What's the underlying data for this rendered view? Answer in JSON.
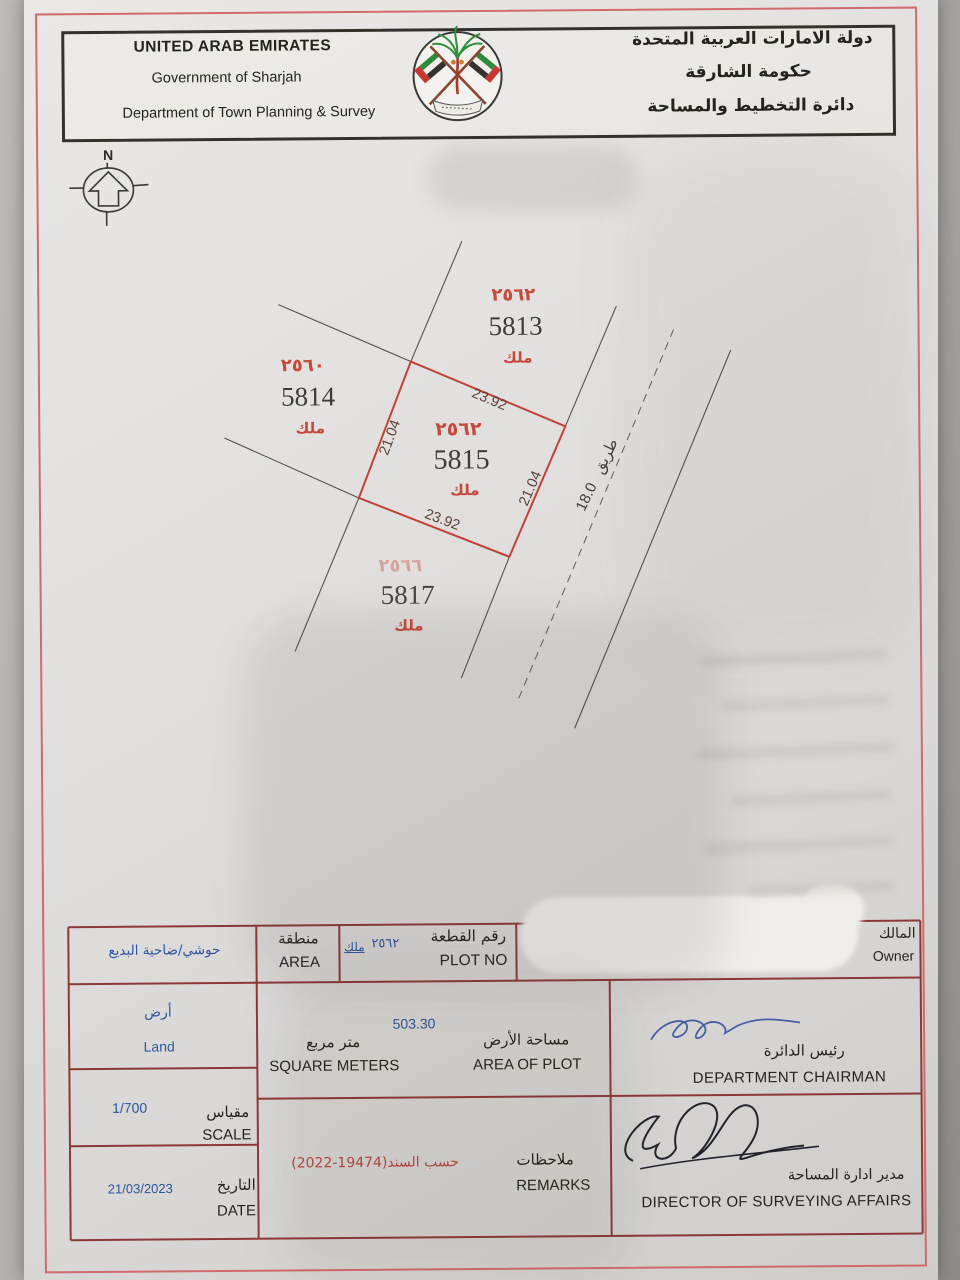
{
  "header": {
    "en_line1": "UNITED ARAB EMIRATES",
    "en_line2": "Government of Sharjah",
    "en_line3": "Department of Town Planning & Survey",
    "ar_line1": "دولة الامارات العربية المتحدة",
    "ar_line2": "حكومة الشارقة",
    "ar_line3": "دائرة التخطيط والمساحة",
    "emblem": "sharjah-uae-crossed-flags-palm-emblem"
  },
  "map": {
    "north_label": "N",
    "plots": [
      {
        "id": "5813",
        "serial_ar": "٢٥٦٢",
        "ownership_ar": "ملك"
      },
      {
        "id": "5814",
        "serial_ar": "٢٥٦٠",
        "ownership_ar": "ملك"
      },
      {
        "id": "5815",
        "serial_ar": "٢٥٦٢",
        "ownership_ar": "ملك",
        "highlighted": true
      },
      {
        "id": "5817",
        "serial_ar": "٢٥٦٦",
        "ownership_ar": "ملك",
        "faded": true
      }
    ],
    "dimensions": {
      "top": "23.92",
      "left": "21.04",
      "right": "21.04",
      "bottom": "23.92"
    },
    "road": {
      "label_ar": "طريق",
      "width": "18.0"
    },
    "colors": {
      "plot_outline": "#c24238",
      "serial_red": "#c64a3c",
      "boundary_line": "#55514d"
    }
  },
  "table": {
    "row_plot": {
      "area_value_ar": "حوشي/ضاحية البديع",
      "area_label_ar": "منطقة",
      "area_label_en": "AREA",
      "mulk_ar": "ملك",
      "plot_no_value_ar": "٢٥٦٢",
      "plot_label_ar": "رقم القطعة",
      "plot_label_en": "PLOT NO",
      "owner_label_ar": "المالك",
      "owner_label_en": "Owner"
    },
    "row_area": {
      "type_ar": "أرض",
      "type_en": "Land",
      "value": "503.30",
      "unit_ar": "متر مربع",
      "unit_en": "SQUARE METERS",
      "label_ar": "مساحة الأرض",
      "label_en": "AREA OF PLOT",
      "chairman_ar": "رئيس الدائرة",
      "chairman_en": "DEPARTMENT CHAIRMAN"
    },
    "row_scale": {
      "value": "1/700",
      "label_ar": "مقياس",
      "label_en": "SCALE"
    },
    "row_date": {
      "value": "21/03/2023",
      "label_ar": "التاريخ",
      "label_en": "DATE"
    },
    "row_remarks": {
      "value_ar": "حسب السند⁦(2022-19474)⁩",
      "label_ar": "ملاحظات",
      "label_en": "REMARKS",
      "director_ar": "مدير ادارة المساحة",
      "director_en": "DIRECTOR OF SURVEYING AFFAIRS"
    },
    "colors": {
      "grid_line": "#8c3836",
      "value_blue": "#2d55a0",
      "remark_red": "#b5463c"
    }
  }
}
